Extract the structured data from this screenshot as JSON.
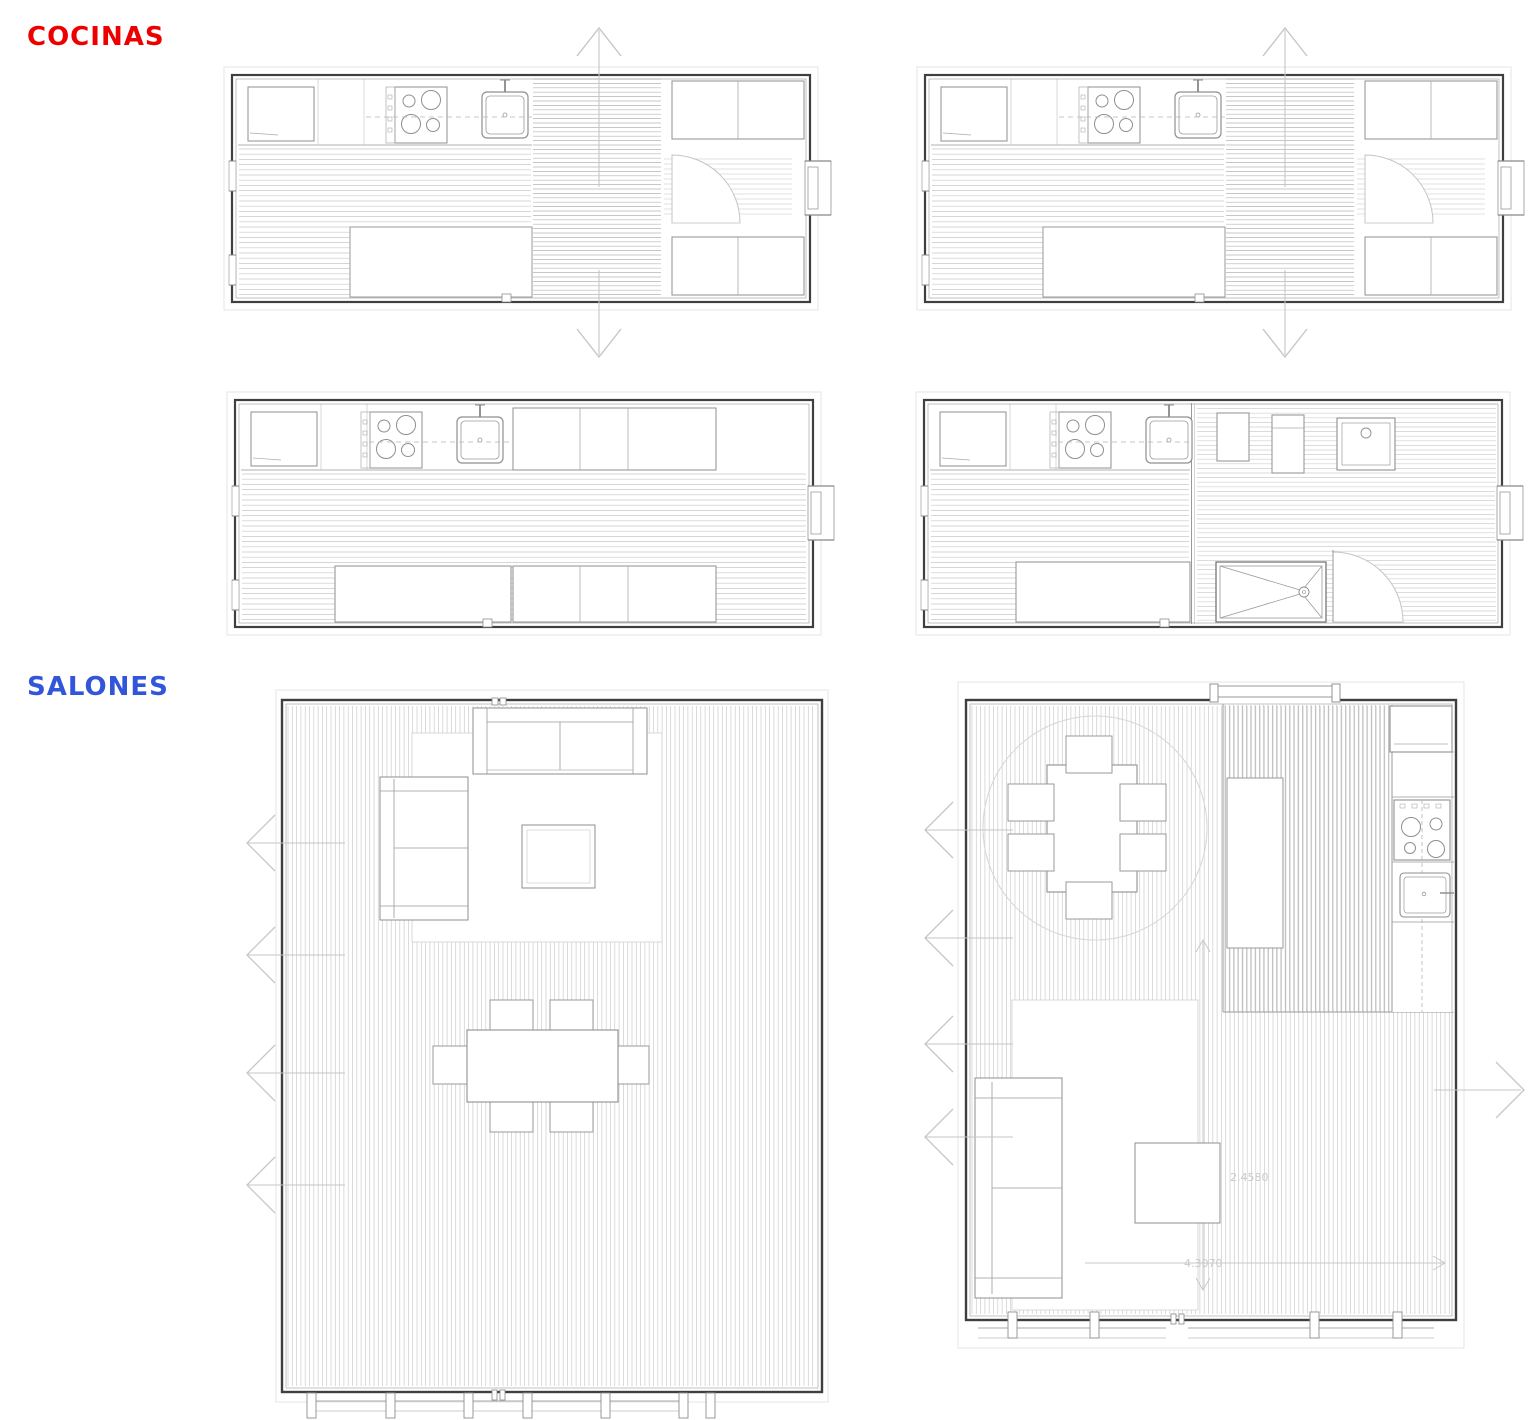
{
  "page": {
    "background": "#ffffff"
  },
  "sections": [
    {
      "id": "cocinas",
      "label": "COCINAS",
      "color": "#ee0000"
    },
    {
      "id": "salones",
      "label": "SALONES",
      "color": "#3355d9"
    }
  ],
  "plans": [
    {
      "name": "kitchen-plan-top-left",
      "section": "COCINAS"
    },
    {
      "name": "kitchen-plan-top-right",
      "section": "COCINAS"
    },
    {
      "name": "kitchen-plan-middle-left",
      "section": "COCINAS"
    },
    {
      "name": "kitchen-plan-middle-right-with-bath",
      "section": "COCINAS"
    },
    {
      "name": "salon-plan-left",
      "section": "SALONES"
    },
    {
      "name": "salon-plan-right-with-kitchen",
      "section": "SALONES"
    }
  ],
  "annotations": {
    "dim_vertical": "2.4580",
    "dim_horizontal": "4.3070",
    "color": "#c9c9c9"
  },
  "drawing_colors": {
    "wall": "#3f3f3f",
    "line_medium": "#8f8f8f",
    "line_light": "#b5b5b5",
    "hatch": "#c9c9c9",
    "hatch_dark": "#b4b4b4",
    "arrow": "#c6c6c6",
    "faint": "#e4e4e4"
  }
}
